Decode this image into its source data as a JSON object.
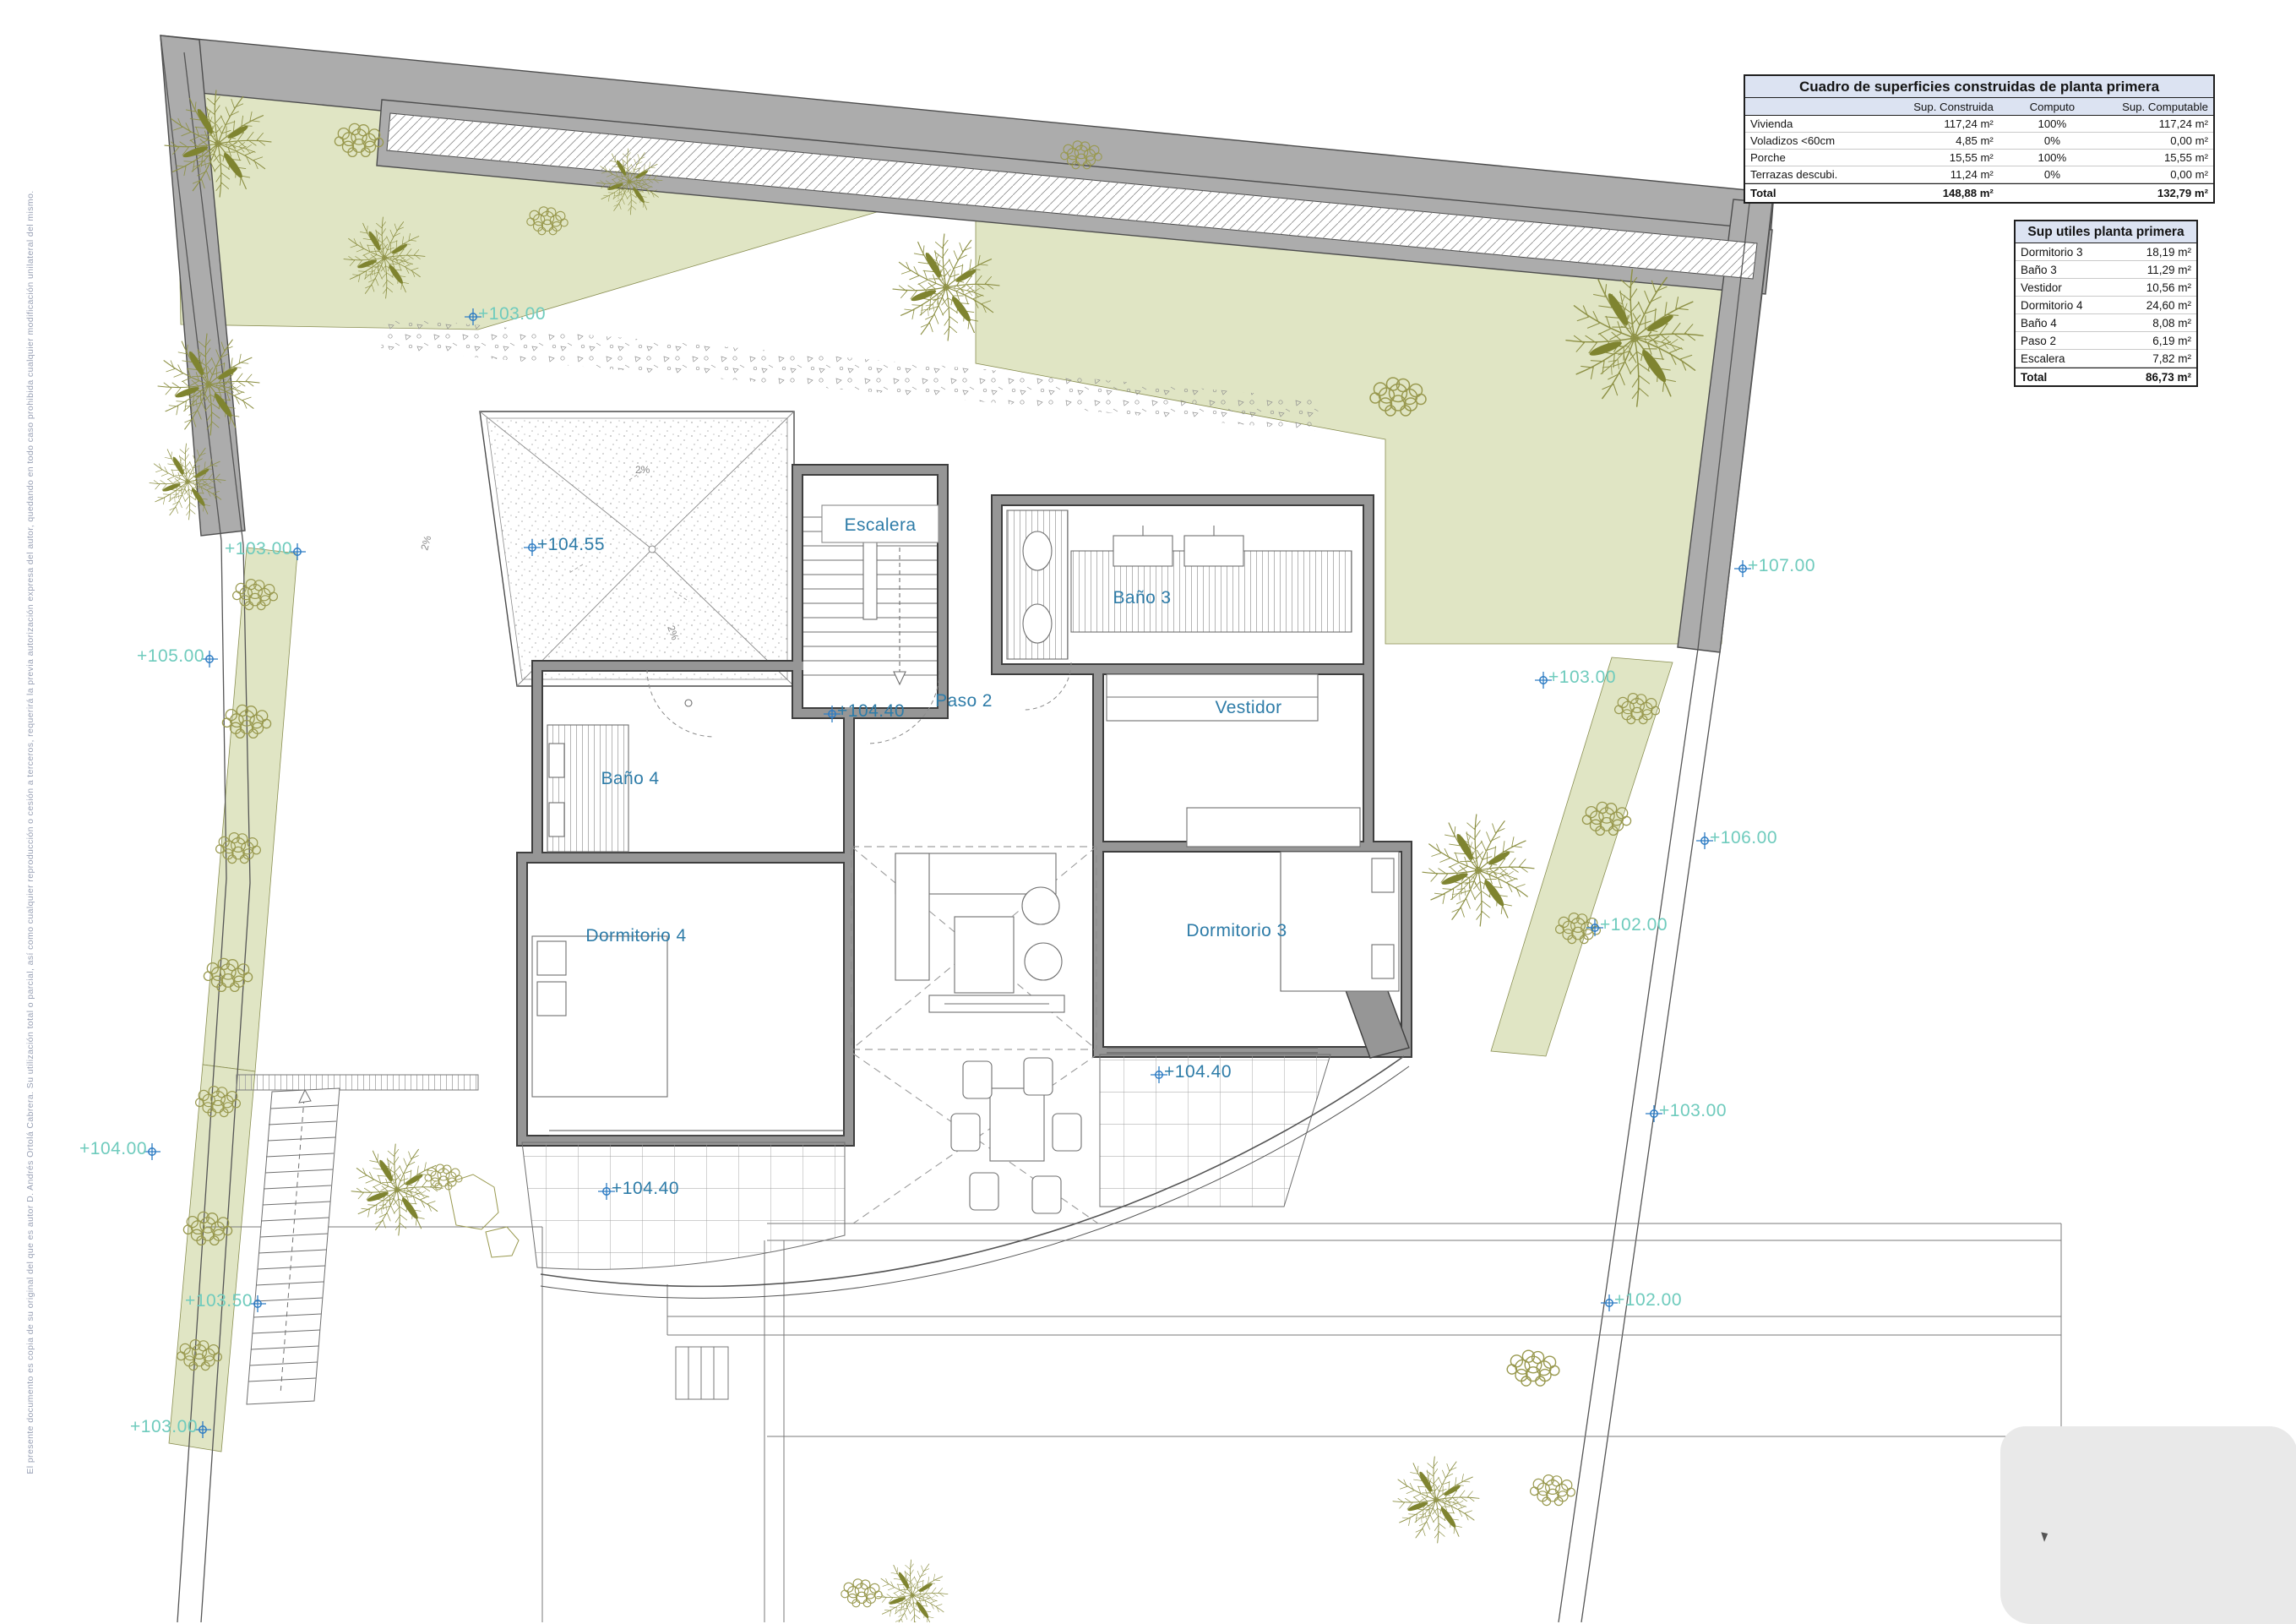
{
  "page": {
    "background": "#ffffff"
  },
  "colors": {
    "site_marker_text": "#6fcbbd",
    "interior_marker_text": "#2e7ca8",
    "marker_icon": "#2d7cc4",
    "green_fill": "#e0e5c4",
    "plant_stroke": "#98994d",
    "boundary_gray": "#acacac",
    "wall_gray": "#969696",
    "table_header_bg": "#dce3f2"
  },
  "tables": {
    "constructed": {
      "title": "Cuadro de superficies construidas de planta primera",
      "columns": [
        "",
        "Sup. Construida",
        "Computo",
        "Sup. Computable"
      ],
      "rows": [
        {
          "name": "Vivienda",
          "constructed": "117,24 m²",
          "computo": "100%",
          "computable": "117,24 m²"
        },
        {
          "name": "Voladizos <60cm",
          "constructed": "4,85 m²",
          "computo": "0%",
          "computable": "0,00 m²"
        },
        {
          "name": "Porche",
          "constructed": "15,55 m²",
          "computo": "100%",
          "computable": "15,55 m²"
        },
        {
          "name": "Terrazas descubi.",
          "constructed": "11,24 m²",
          "computo": "0%",
          "computable": "0,00 m²"
        }
      ],
      "total": {
        "name": "Total",
        "constructed": "148,88 m²",
        "computo": "",
        "computable": "132,79 m²"
      }
    },
    "useful": {
      "title": "Sup utiles planta primera",
      "rows": [
        {
          "name": "Dormitorio 3",
          "area": "18,19 m²"
        },
        {
          "name": "Baño 3",
          "area": "11,29 m²"
        },
        {
          "name": "Vestidor",
          "area": "10,56 m²"
        },
        {
          "name": "Dormitorio 4",
          "area": "24,60 m²"
        },
        {
          "name": "Baño 4",
          "area": "8,08 m²"
        },
        {
          "name": "Paso 2",
          "area": "6,19 m²"
        },
        {
          "name": "Escalera",
          "area": "7,82 m²"
        }
      ],
      "total": {
        "name": "Total",
        "area": "86,73 m²"
      }
    }
  },
  "plan": {
    "rooms": [
      {
        "label": "Escalera"
      },
      {
        "label": "Baño 3"
      },
      {
        "label": "Vestidor"
      },
      {
        "label": "Paso 2"
      },
      {
        "label": "Baño 4"
      },
      {
        "label": "Dormitorio 4"
      },
      {
        "label": "Dormitorio 3"
      }
    ],
    "roof_slope_label": "2%",
    "markers": [
      {
        "value": "+103.00",
        "kind": "site"
      },
      {
        "value": "+103.00",
        "kind": "site"
      },
      {
        "value": "+105.00",
        "kind": "site"
      },
      {
        "value": "+104.55",
        "kind": "interior"
      },
      {
        "value": "+104.40",
        "kind": "interior"
      },
      {
        "value": "+104.40",
        "kind": "interior"
      },
      {
        "value": "+104.40",
        "kind": "interior"
      },
      {
        "value": "+107.00",
        "kind": "site"
      },
      {
        "value": "+103.00",
        "kind": "site"
      },
      {
        "value": "+106.00",
        "kind": "site"
      },
      {
        "value": "+102.00",
        "kind": "site"
      },
      {
        "value": "+103.00",
        "kind": "site"
      },
      {
        "value": "+102.00",
        "kind": "site"
      },
      {
        "value": "+104.00",
        "kind": "site"
      },
      {
        "value": "+103.50",
        "kind": "site"
      },
      {
        "value": "+103.00",
        "kind": "site"
      }
    ]
  },
  "disclaimer": "El presente documento es copia de su original del que es autor D. Andrés Ortolá Cabrera. Su utilización total o parcial, así como cualquier reproducción o cesión a terceros, requerirá la previa autorización expresa del autor, quedando en todo caso prohibida cualquier modificación unilateral del mismo."
}
